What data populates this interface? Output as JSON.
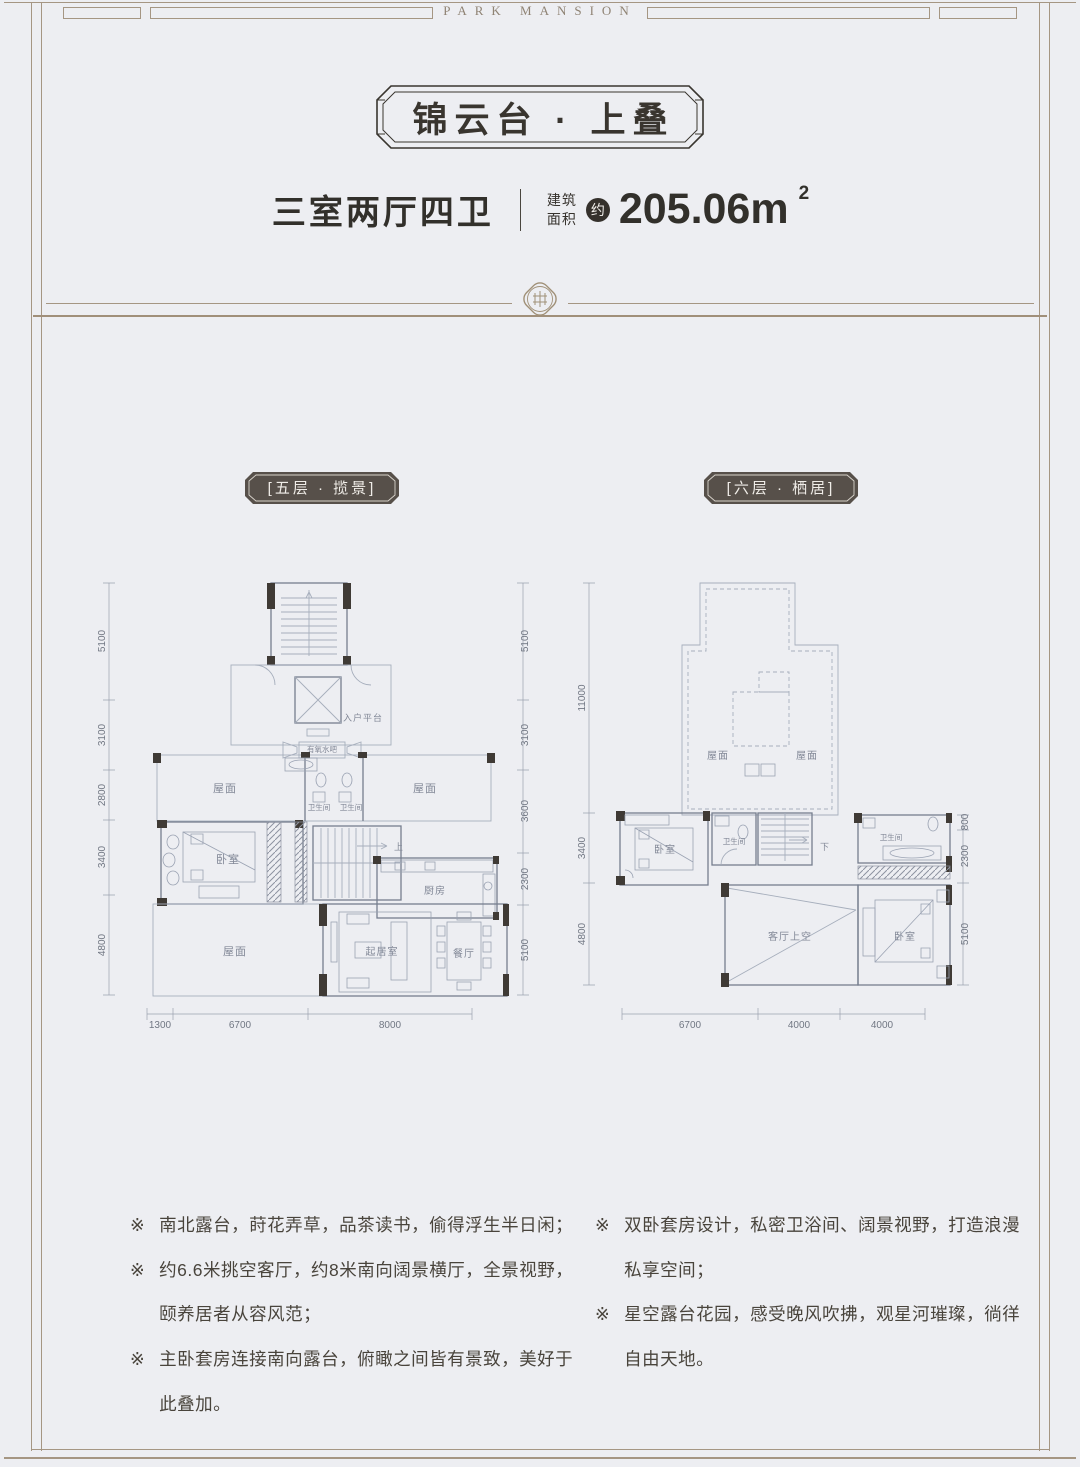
{
  "brand": "PARK MANSION",
  "header": {
    "title": "锦云台 · 上叠",
    "layout": "三室两厅四卫",
    "area_label_line1": "建筑",
    "area_label_line2": "面积",
    "area_approx": "约",
    "area_value": "205.06m",
    "area_sup": "2"
  },
  "colors": {
    "background": "#edeef2",
    "frame": "#a59683",
    "ink": "#37332e",
    "badge_bg": "#57504a",
    "plan_wall_dark": "#3f3a35",
    "plan_line_light": "#a6aebc"
  },
  "plans": {
    "left": {
      "badge": "[五层 · 揽景]",
      "dims_left": [
        "5100",
        "3100",
        "2800",
        "3400",
        "4800"
      ],
      "dims_right": [
        "5100",
        "3100",
        "3600",
        "2300",
        "5100"
      ],
      "dims_bottom": [
        "1300",
        "6700",
        "8000"
      ],
      "rooms": {
        "entry": "入户平台",
        "waterbar": "有氧水吧",
        "bath1": "卫生间",
        "bath2": "卫生间",
        "roof_left": "屋面",
        "roof_right": "屋面",
        "bedroom": "卧室",
        "kitchen": "厨房",
        "terrace": "屋面",
        "living": "起居室",
        "dining": "餐厅",
        "stair_up": "上"
      }
    },
    "right": {
      "badge": "[六层 · 栖居]",
      "dims_left": [
        "11000",
        "3400",
        "4800"
      ],
      "dims_right": [
        "800",
        "2300",
        "5100"
      ],
      "dims_bottom": [
        "6700",
        "4000",
        "4000"
      ],
      "rooms": {
        "roof_left": "屋面",
        "roof_right": "屋面",
        "bedroom_left": "卧室",
        "bath_mid": "卫生间",
        "bath_right": "卫生间",
        "void": "客厅上空",
        "bedroom_right": "卧室",
        "stair_down": "下"
      }
    }
  },
  "features": {
    "marker": "※",
    "left": [
      "南北露台，莳花弄草，品茶读书，偷得浮生半日闲；",
      "约6.6米挑空客厅，约8米南向阔景横厅，全景视野，颐养居者从容风范；",
      "主卧套房连接南向露台，俯瞰之间皆有景致，美好于此叠加。"
    ],
    "right": [
      "双卧套房设计，私密卫浴间、阔景视野，打造浪漫私享空间；",
      "星空露台花园，感受晚风吹拂，观星河璀璨，徜徉自由天地。"
    ]
  }
}
